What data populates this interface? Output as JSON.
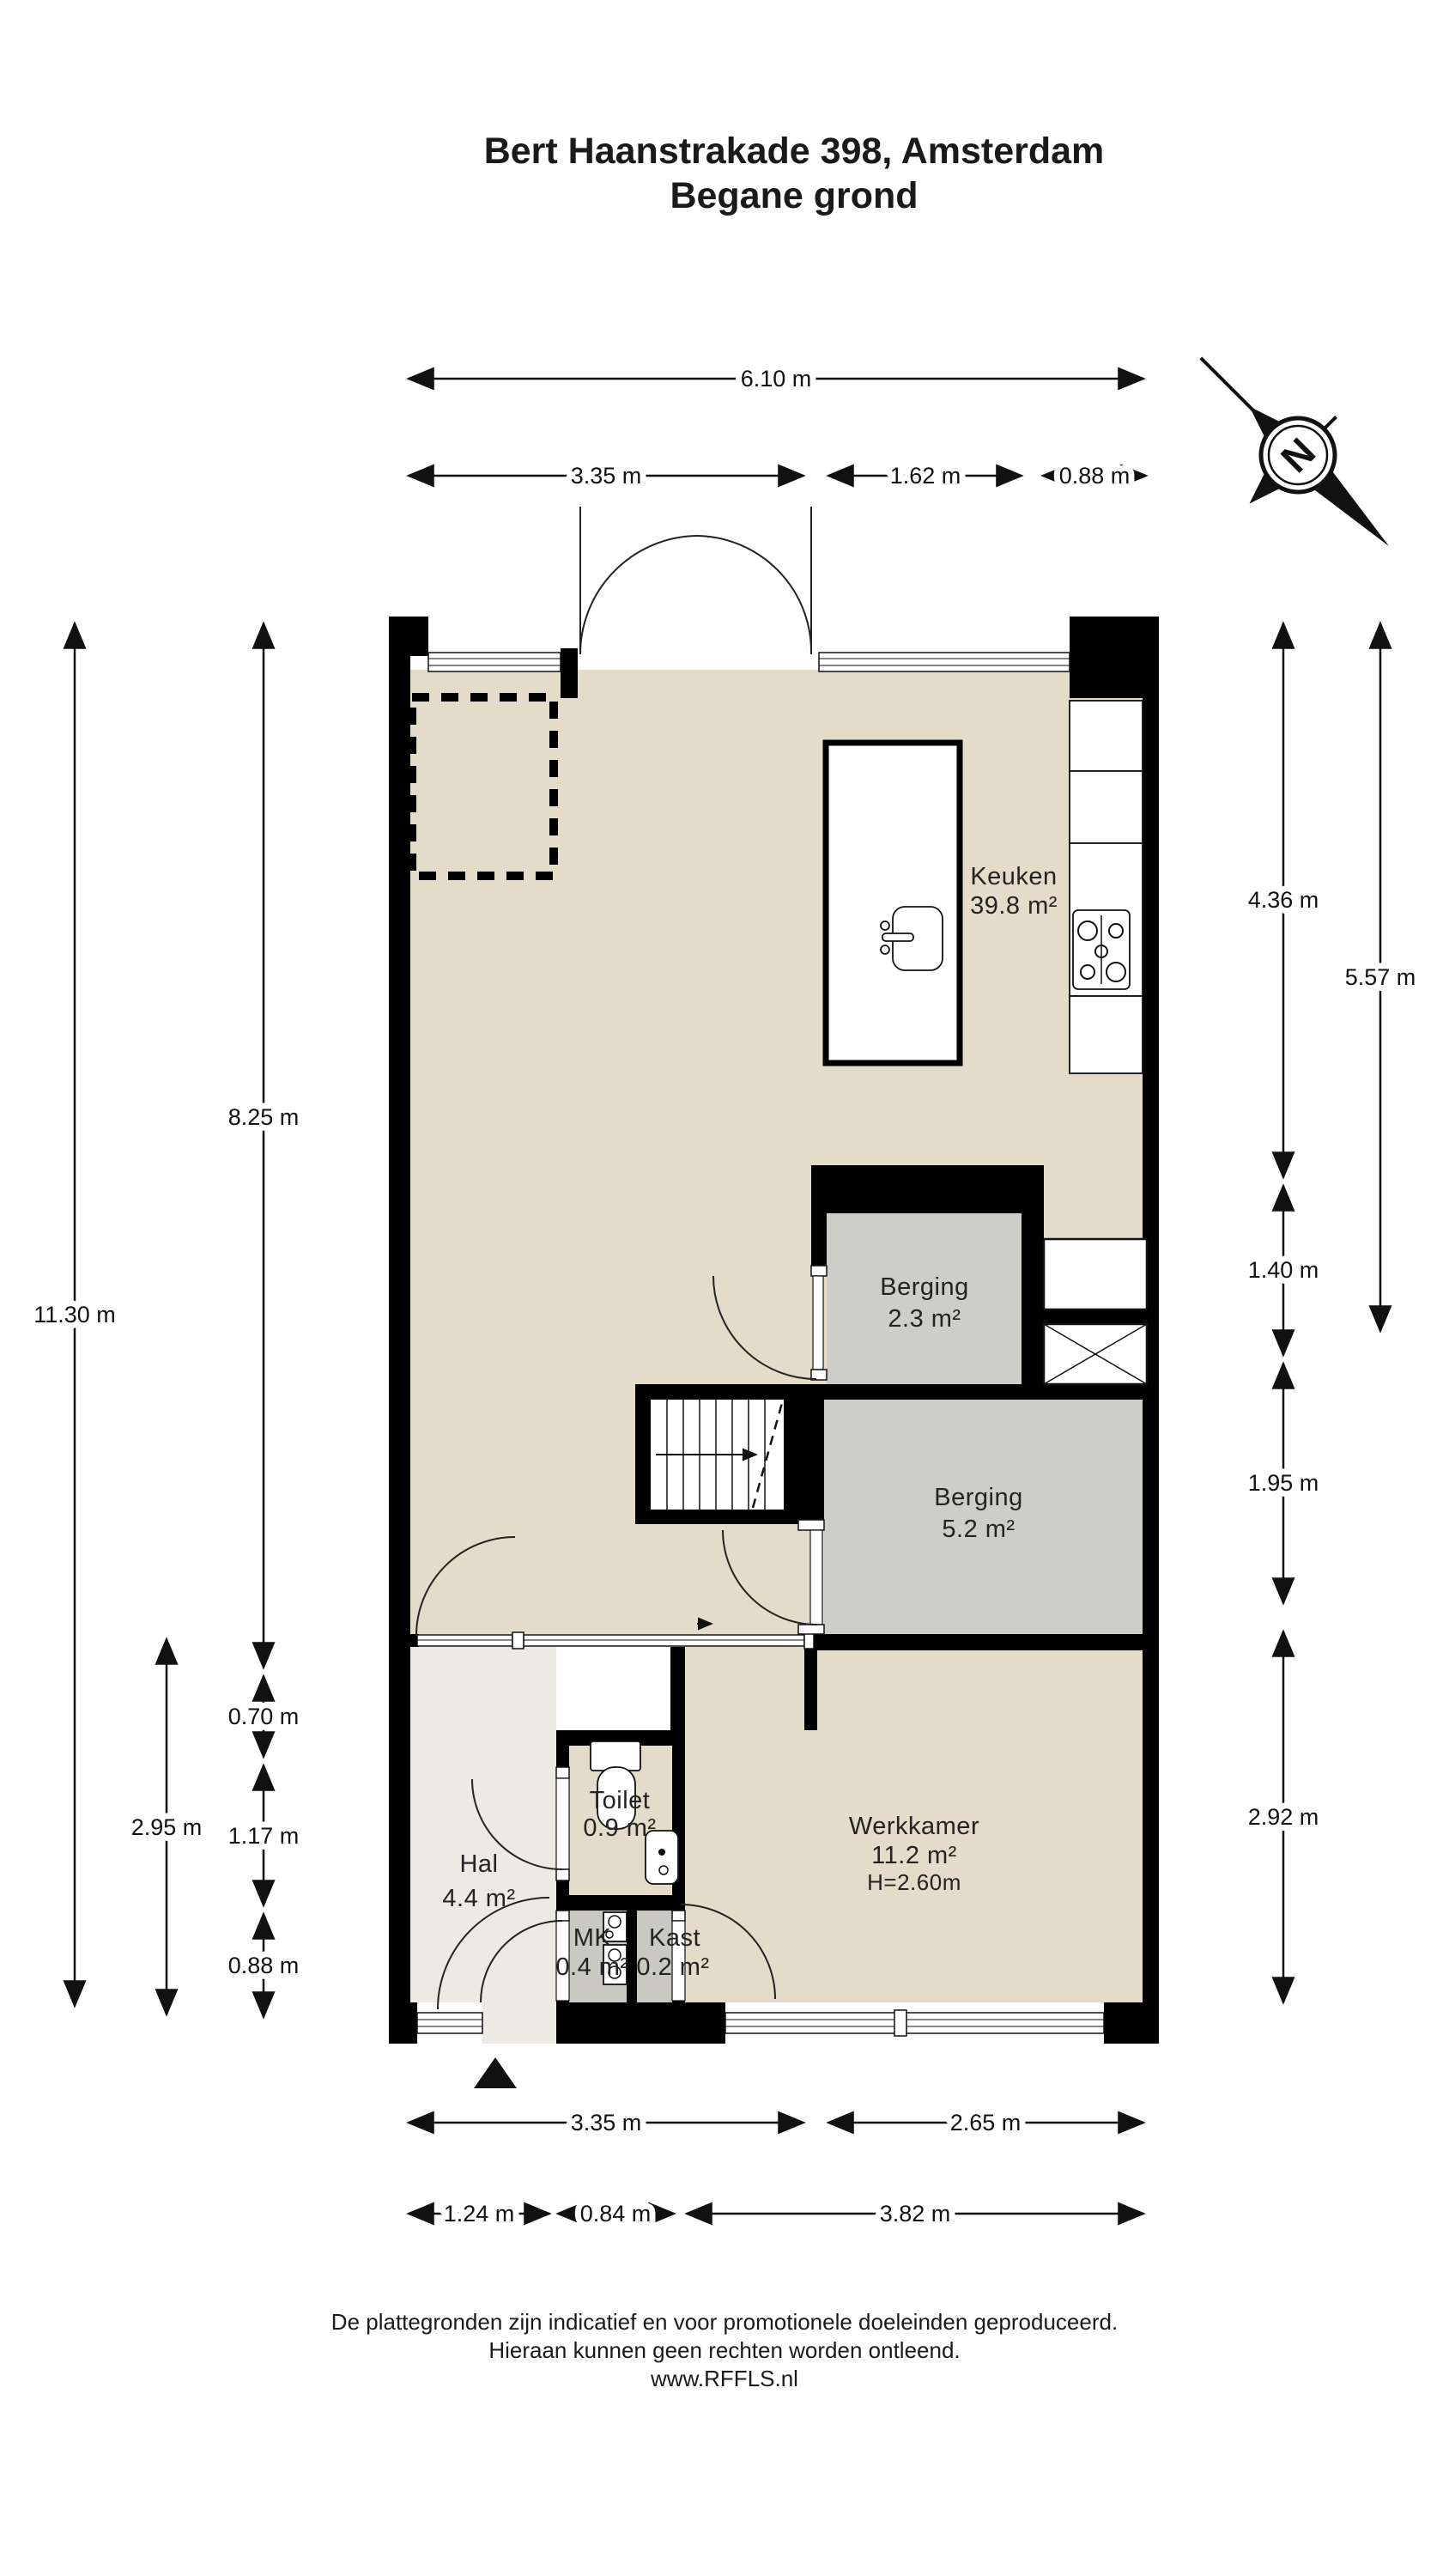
{
  "title": {
    "line1": "Bert Haanstrakade 398, Amsterdam",
    "line2": "Begane grond"
  },
  "compass": {
    "north_label": "N"
  },
  "rooms": {
    "keuken": {
      "name": "Keuken",
      "area": "39.8 m²"
    },
    "berging_klein": {
      "name": "Berging",
      "area": "2.3 m²"
    },
    "berging_groot": {
      "name": "Berging",
      "area": "5.2 m²"
    },
    "werkkamer": {
      "name": "Werkkamer",
      "area": "11.2 m²",
      "height": "H=2.60m"
    },
    "toilet": {
      "name": "Toilet",
      "area": "0.9 m²"
    },
    "hal": {
      "name": "Hal",
      "area": "4.4 m²"
    },
    "mk": {
      "name": "MK",
      "area": "0.4 m²"
    },
    "kast": {
      "name": "Kast",
      "area": "0.2 m²"
    }
  },
  "dimensions": {
    "top_total": "6.10 m",
    "top_left": "3.35 m",
    "top_mid": "1.62 m",
    "top_right": "0.88 m",
    "left_total": "11.30 m",
    "left_upper": "8.25 m",
    "left_small1": "0.70 m",
    "left_small2": "1.17 m",
    "left_small3": "0.88 m",
    "left_hall": "2.95 m",
    "right_kitchen": "4.36 m",
    "right_outer": "5.57 m",
    "right_shaft": "1.40 m",
    "right_berging": "1.95 m",
    "right_werkkamer": "2.92 m",
    "bottom_left": "3.35 m",
    "bottom_right": "2.65 m",
    "bottom_row2_left": "1.24 m",
    "bottom_row2_mid": "0.84 m",
    "bottom_row2_right": "3.82 m"
  },
  "footer": {
    "line1": "De plattegronden zijn indicatief en voor promotionele doeleinden geproduceerd.",
    "line2": "Hieraan kunnen geen rechten worden ontleend.",
    "line3": "www.RFFLS.nl"
  },
  "colors": {
    "floor_living": "#e4dbc8",
    "floor_hal": "#eceae3",
    "floor_storage": "#cdcec7",
    "wall": "#000000"
  }
}
